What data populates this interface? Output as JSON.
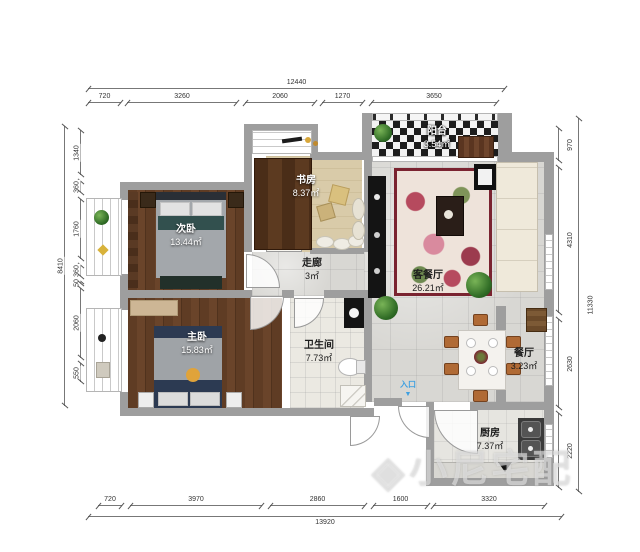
{
  "rooms": {
    "balcony": {
      "name": "阳台",
      "area": "3.54㎡"
    },
    "study": {
      "name": "书房",
      "area": "8.37㎡"
    },
    "secondary_bedroom": {
      "name": "次卧",
      "area": "13.44㎡"
    },
    "corridor": {
      "name": "走廊",
      "area": "3㎡"
    },
    "living_dining": {
      "name": "客餐厅",
      "area": "26.21㎡"
    },
    "master_bedroom": {
      "name": "主卧",
      "area": "15.83㎡"
    },
    "bathroom": {
      "name": "卫生间",
      "area": "7.73㎡"
    },
    "dining": {
      "name": "餐厅",
      "area": "3.23㎡"
    },
    "kitchen": {
      "name": "厨房",
      "area": "7.37㎡"
    }
  },
  "entrance": {
    "label": "入口",
    "arrow": "▼"
  },
  "watermark": {
    "icon": "◈",
    "text": "小尼宅配"
  },
  "dims": {
    "top": {
      "total": "12440",
      "segments": [
        "720",
        "3260",
        "2060",
        "1270",
        "3650"
      ]
    },
    "bottom": {
      "total": "13920",
      "segments": [
        "720",
        "3970",
        "2860",
        "1600",
        "3320"
      ]
    },
    "left": {
      "total": "8410",
      "segments": [
        "1340",
        "360",
        "1760",
        "360",
        "50",
        "2060",
        "550"
      ]
    },
    "right": {
      "total": "11330",
      "segments": [
        "970",
        "4310",
        "2630",
        "2220"
      ]
    }
  },
  "colors": {
    "wall": "#9e9e9e",
    "wood_floor": "#5f3c24",
    "tile_floor": "#d8d7d3",
    "accent_entrance": "#3fa0e0",
    "rug_border": "#7a2330"
  }
}
